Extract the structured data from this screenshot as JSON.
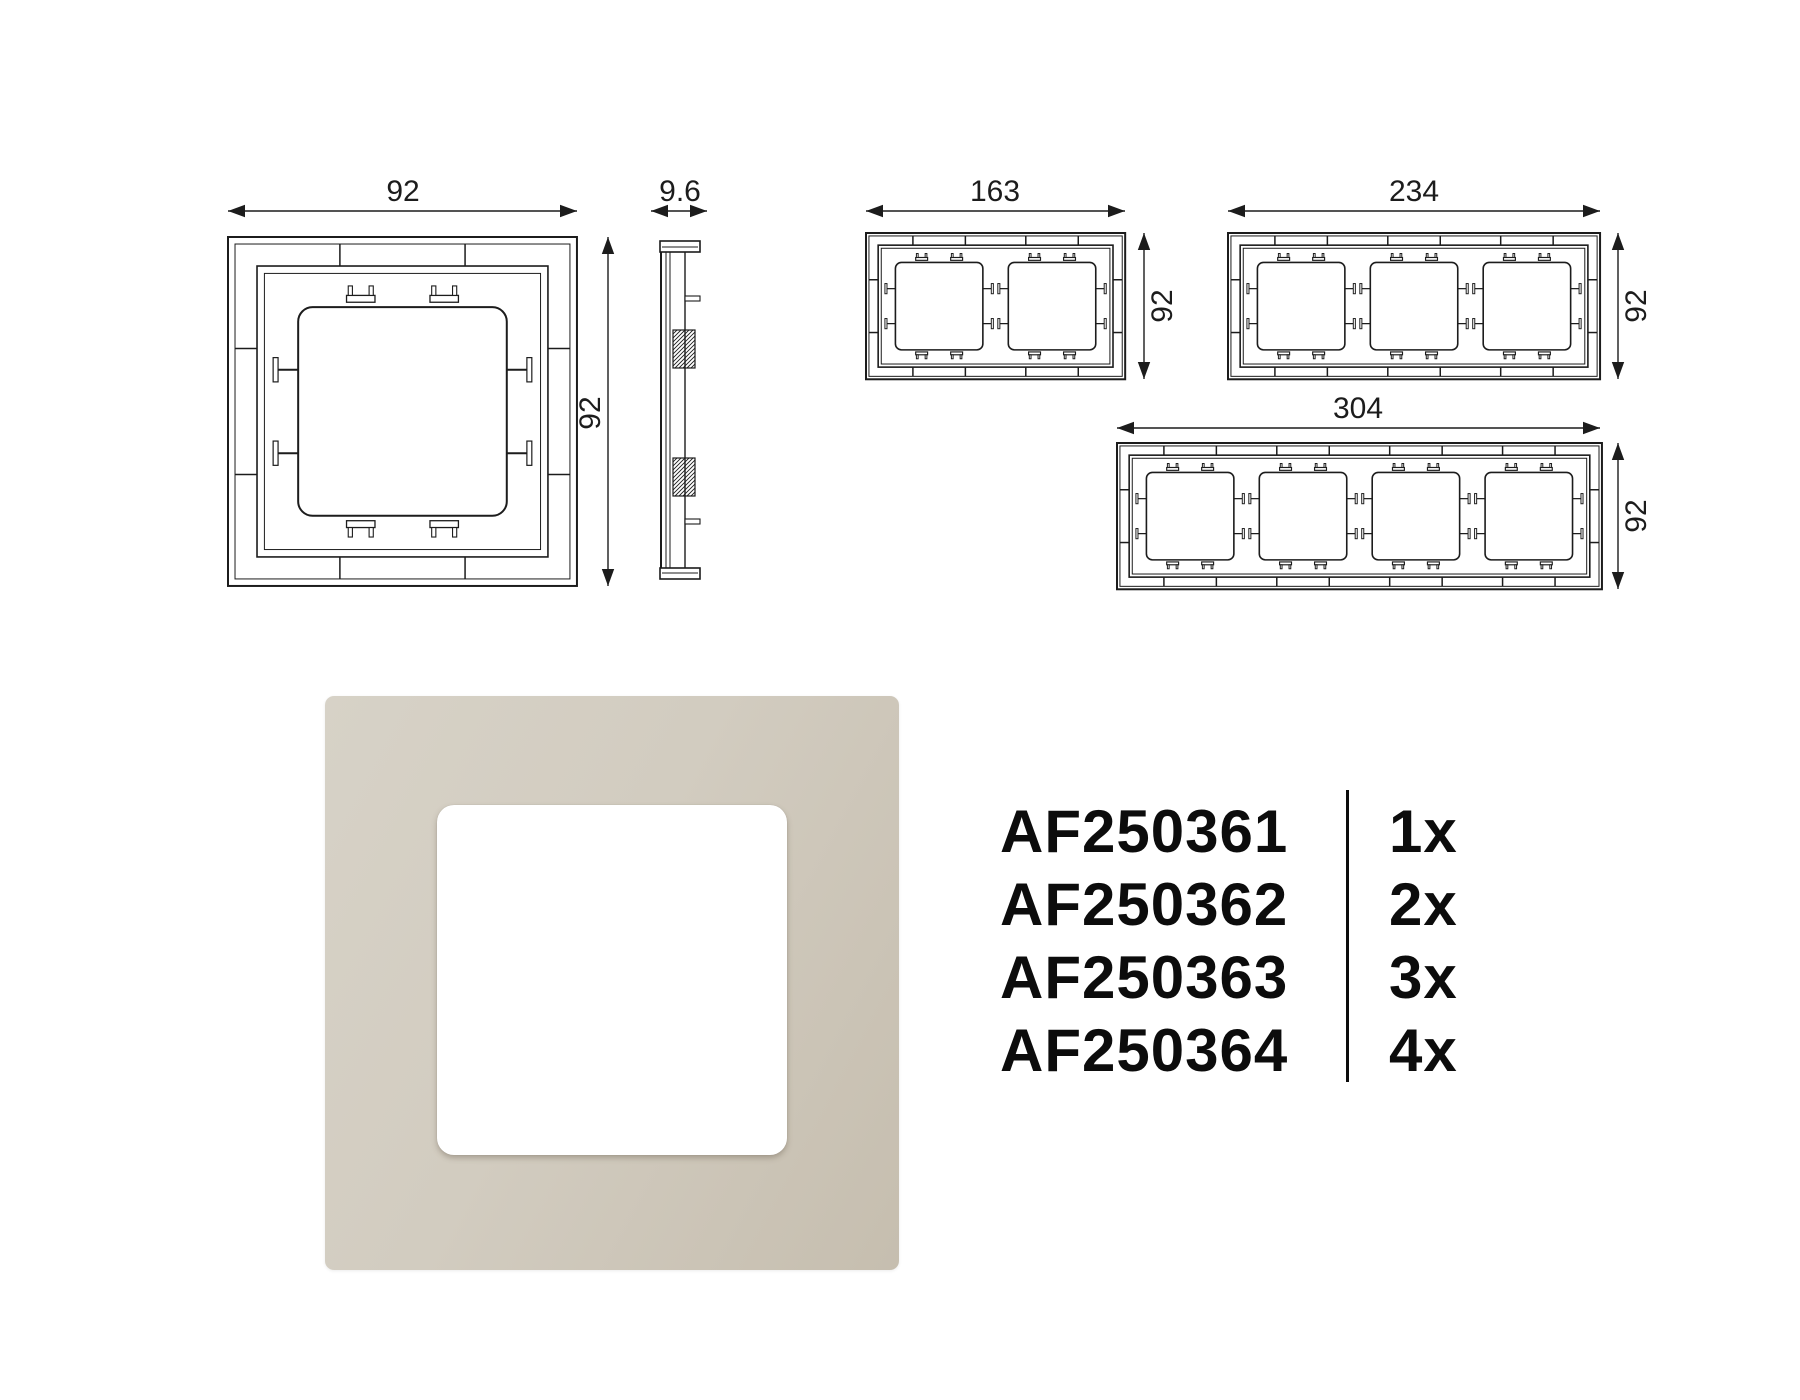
{
  "dimensions": {
    "single_front": {
      "width": "92",
      "height": "92"
    },
    "side_profile": {
      "thickness": "9.6"
    },
    "two_gang": {
      "width": "163",
      "height": "92"
    },
    "three_gang": {
      "width": "234",
      "height": "92"
    },
    "four_gang": {
      "width": "304",
      "height": "92"
    }
  },
  "product_list": [
    {
      "code": "AF250361",
      "qty": "1x"
    },
    {
      "code": "AF250362",
      "qty": "2x"
    },
    {
      "code": "AF250363",
      "qty": "3x"
    },
    {
      "code": "AF250364",
      "qty": "4x"
    }
  ],
  "colors": {
    "line": "#1c1c1c",
    "text": "#111111",
    "frame_beige_light": "#d7d2c7",
    "frame_beige": "#d2ccc0",
    "frame_beige_dark": "#c6beaf",
    "cutout_white": "#ffffff"
  }
}
